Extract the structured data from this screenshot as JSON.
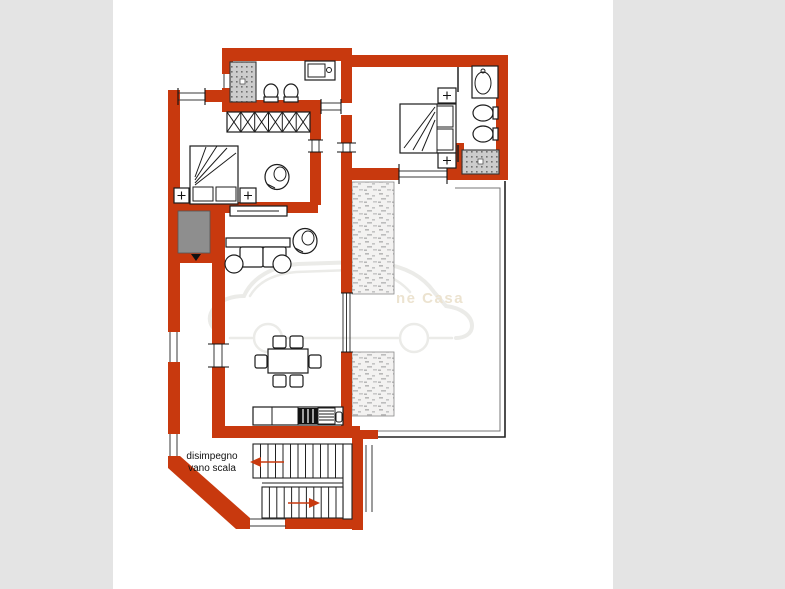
{
  "page": {
    "background": "#e4e4e4",
    "paper": "#ffffff"
  },
  "colors": {
    "wall": "#c8390e",
    "line": "#1c1c1c",
    "grayFill": "#8e8e8e",
    "watermarkText": "#ece3d0",
    "watermarkLine": "#ebebe8",
    "arrow": "#c8390e"
  },
  "labels": {
    "stairwell_line1": "disimpegno",
    "stairwell_line2": "vano scala"
  },
  "watermark": {
    "visible_fragment": "ne Casa"
  }
}
